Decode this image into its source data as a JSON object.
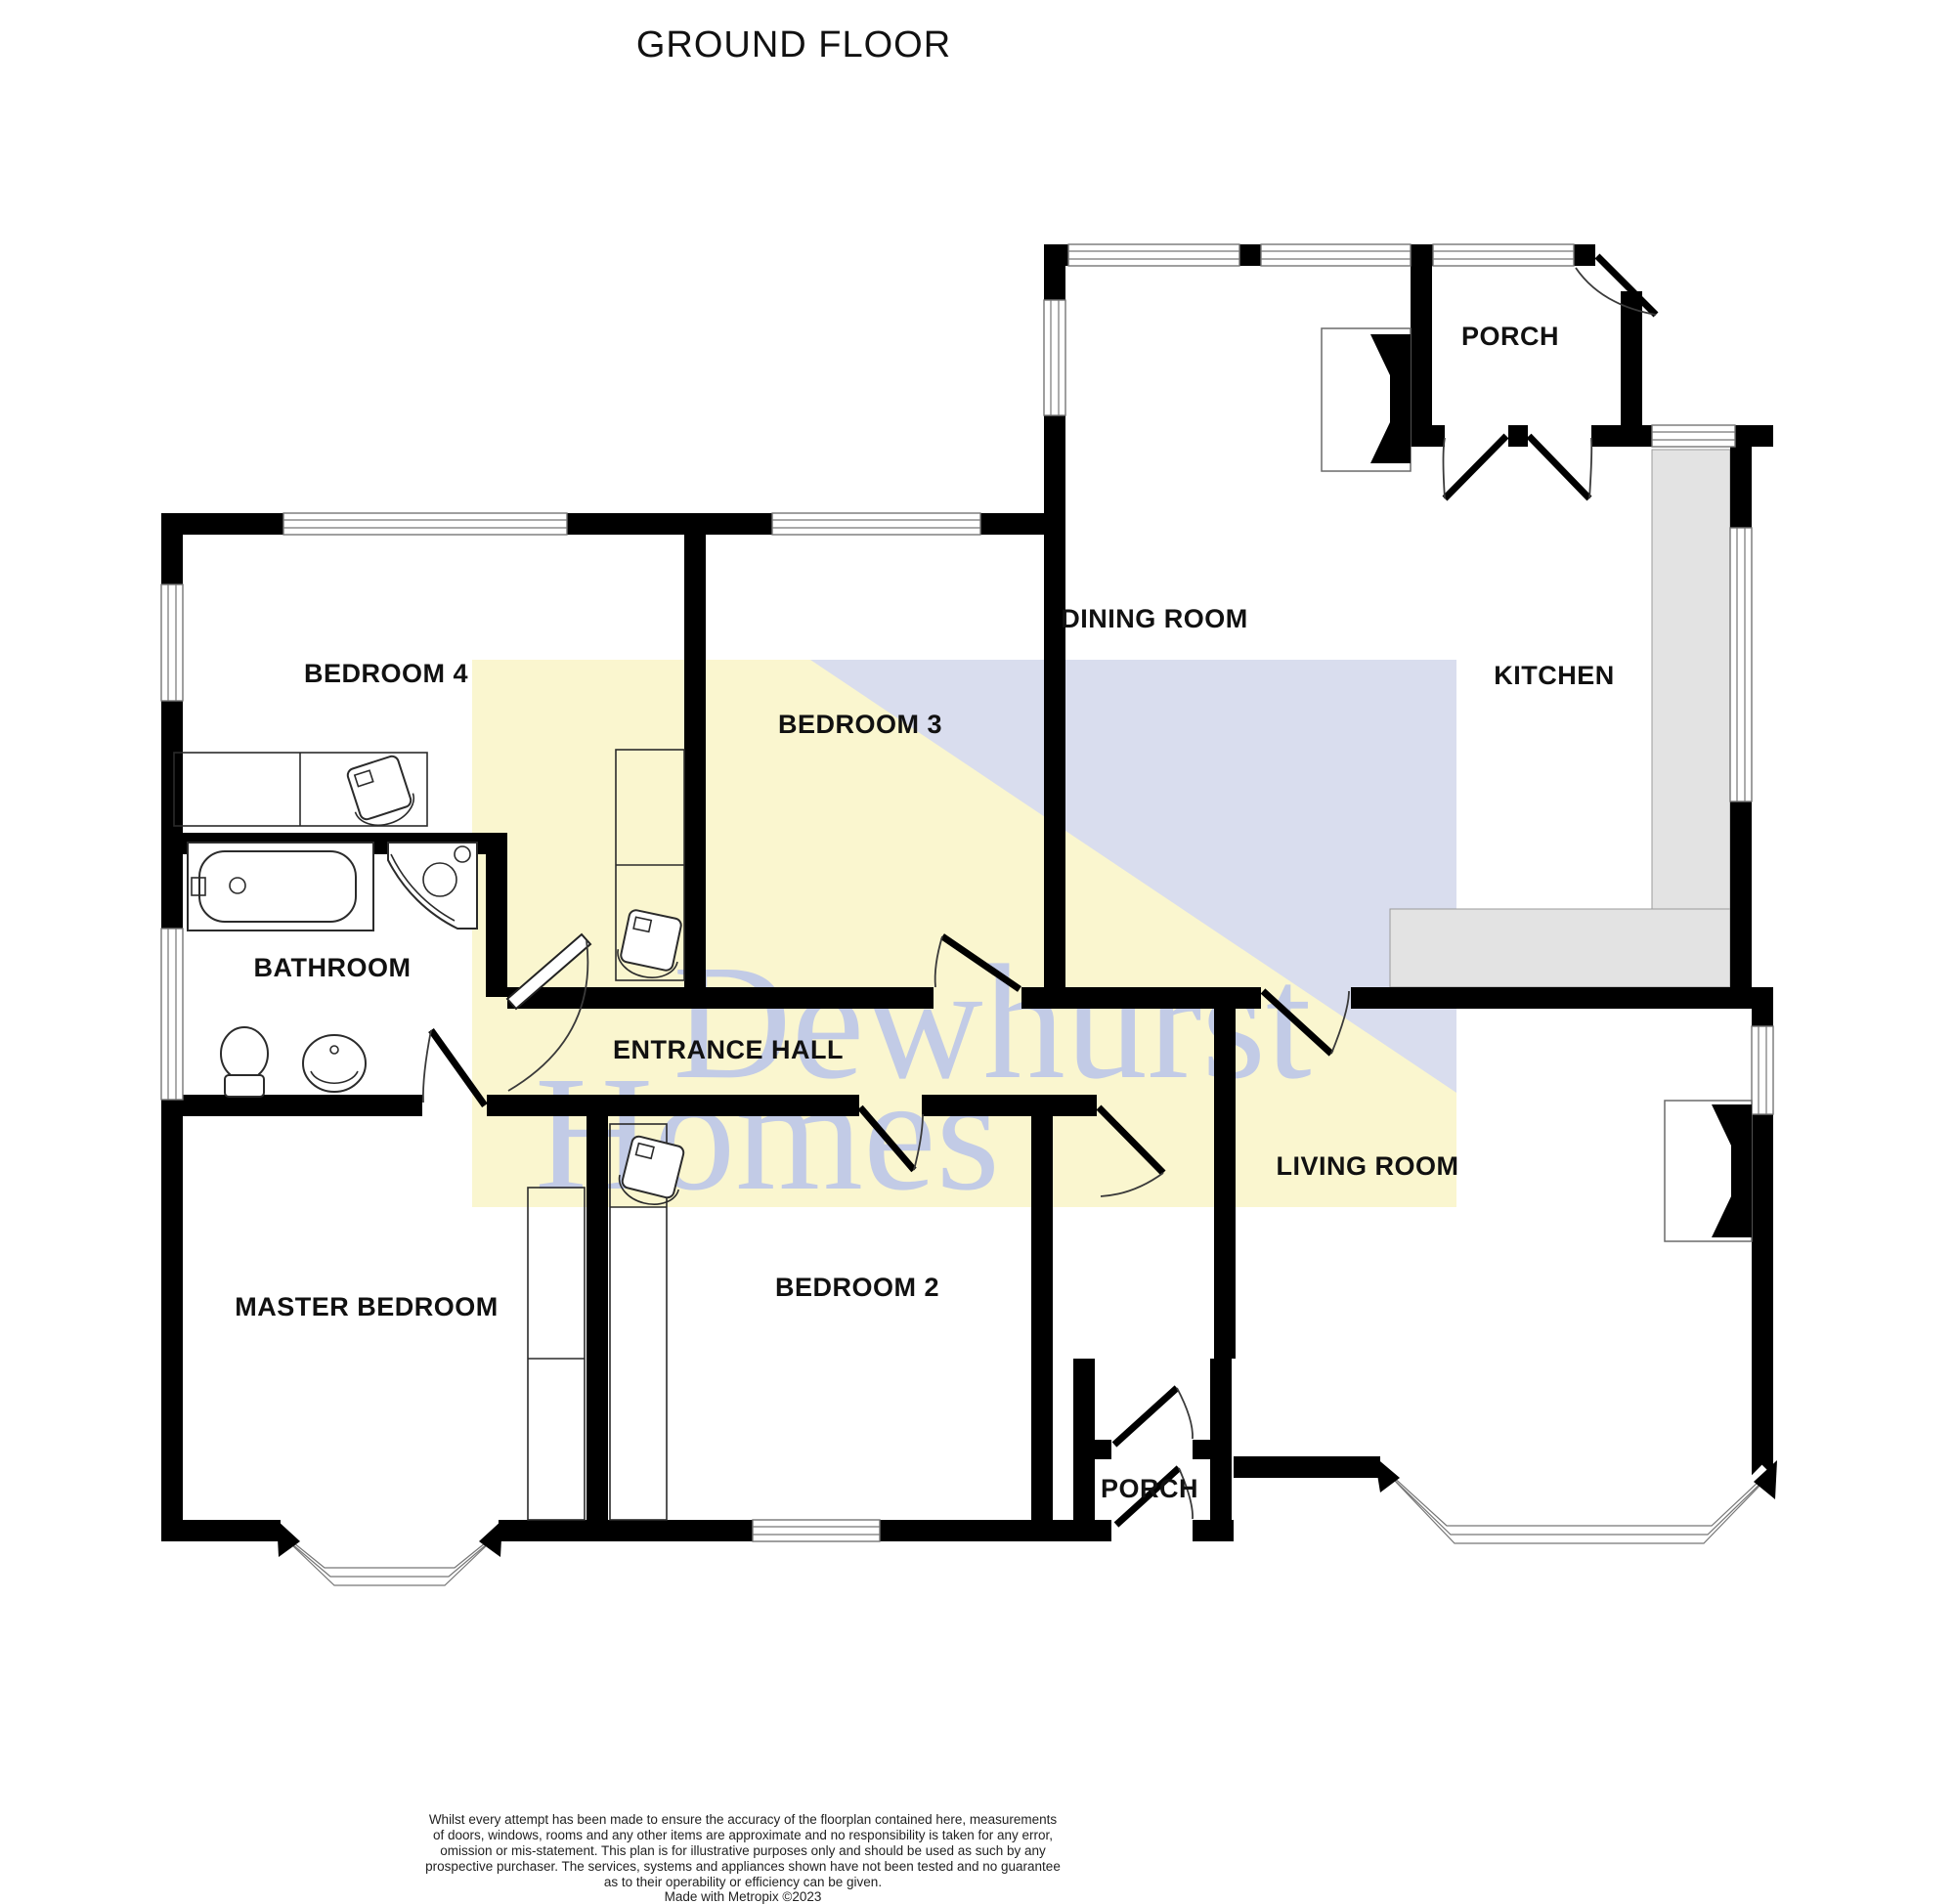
{
  "title": "GROUND FLOOR",
  "watermark": {
    "line1": "Dewhurst",
    "line2": "Homes",
    "yellow_color": "#faf6cf",
    "blue_color": "#d9ddee",
    "text_color": "#c2cbe6"
  },
  "rooms": {
    "bedroom4": "BEDROOM 4",
    "bedroom3": "BEDROOM 3",
    "dining": "DINING ROOM",
    "porch_top": "PORCH",
    "kitchen": "KITCHEN",
    "bathroom": "BATHROOM",
    "hall": "ENTRANCE HALL",
    "master": "MASTER BEDROOM",
    "bedroom2": "BEDROOM 2",
    "porch_bottom": "PORCH",
    "living": "LIVING ROOM"
  },
  "disclaimer": {
    "lines": [
      "Whilst every attempt has been made to ensure the accuracy of the floorplan contained here, measurements",
      "of doors, windows, rooms and any other items are approximate and no responsibility is taken for any error,",
      "omission or mis-statement. This plan is for illustrative purposes only and should be used as such by any",
      "prospective purchaser. The services, systems and appliances shown have not been tested and no guarantee",
      "as to their operability or efficiency can be given.",
      "Made with Metropix ©2023"
    ]
  }
}
